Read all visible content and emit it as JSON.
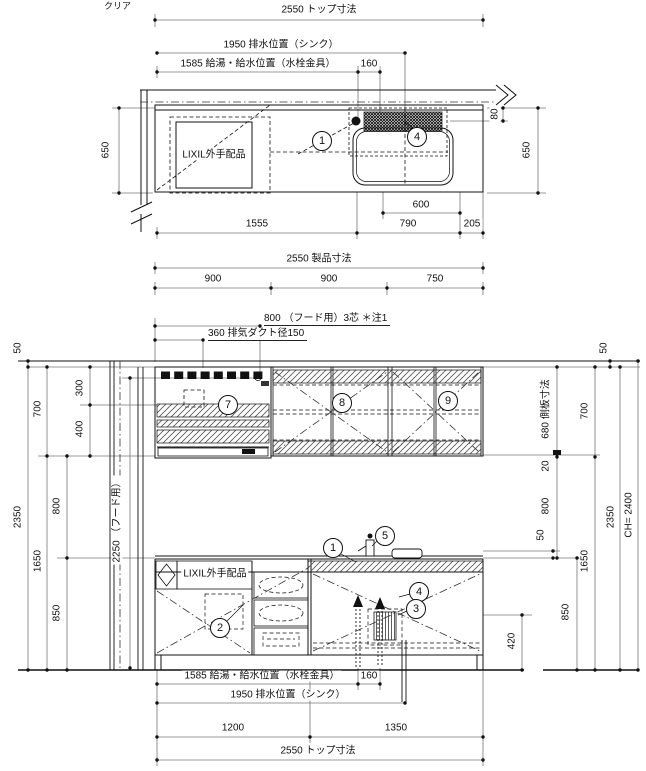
{
  "plan": {
    "clear": "クリア",
    "top": "2550 トップ寸法",
    "drain": "1950 排水位置（シンク）",
    "supply": "1585 給湯・給水位置（水栓金具）",
    "offset160": "160",
    "depth_left": "650",
    "depth_right": "650",
    "d80": "80",
    "d600": "600",
    "d1555": "1555",
    "d790": "790",
    "d205": "205",
    "parts": "LIXIL外手配品",
    "m1": "1",
    "m4": "4"
  },
  "product": {
    "total": "2550 製品寸法",
    "w1": "900",
    "w2": "900",
    "w3": "750"
  },
  "hood": {
    "power": "800 （フード用）3芯 ＊注1",
    "duct": "360 排気ダクト径150"
  },
  "elev": {
    "l50": "50",
    "l700": "700",
    "l300": "300",
    "l400": "400",
    "l2350": "2350",
    "l800": "800",
    "l1650": "1650",
    "l850": "850",
    "hood_h": "2250 （フード用）",
    "r50": "50",
    "r680": "680 側板寸法",
    "r700": "700",
    "r20": "20",
    "r800": "800",
    "r50b": "50",
    "r850": "850",
    "r1650": "1650",
    "r2350": "2350",
    "ch": "CH= 2400",
    "d420": "420",
    "parts": "LIXIL外手配品",
    "m1": "1",
    "m2": "2",
    "m3": "3",
    "m4": "4",
    "m5": "5",
    "m7": "7",
    "m8": "8",
    "m9": "9"
  },
  "bottom": {
    "supply": "1585 給湯・給水位置（水栓金具）",
    "offset160": "160",
    "drain": "1950 排水位置（シンク）",
    "d1200": "1200",
    "d1350": "1350",
    "top": "2550 トップ寸法"
  },
  "colors": {
    "line": "#111111",
    "dim": "#777777",
    "bg": "#ffffff"
  }
}
